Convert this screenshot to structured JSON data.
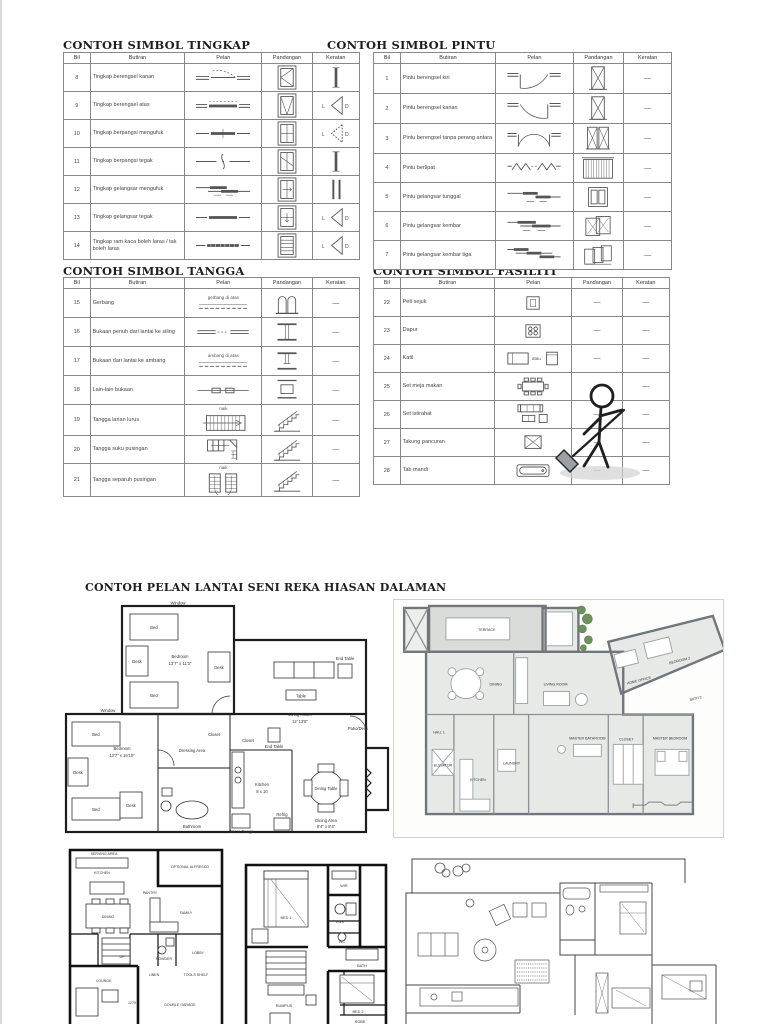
{
  "page": {
    "plans_title": "CONTOH PELAN LANTAI SENI REKA HIASAN DALAMAN"
  },
  "symbols": {
    "letter_left": "L",
    "letter_right": "D",
    "dash": "—"
  },
  "tables": {
    "tingkap": {
      "title": "CONTOH SIMBOL TINGKAP",
      "headers": [
        "Bil",
        "Butiran",
        "Pelan",
        "Pandangan",
        "Keratan"
      ],
      "rows": [
        {
          "bil": "8",
          "butiran": "Tingkap berengsel kanan",
          "pelan": {
            "icon": "window-casement-plan"
          },
          "pandangan": {
            "icon": "window-elev-casement"
          },
          "keratan": {
            "icon": "section-bar"
          }
        },
        {
          "bil": "9",
          "butiran": "Tingkap berengsel atas",
          "pelan": {
            "icon": "window-sash-plan"
          },
          "pandangan": {
            "icon": "window-elev-tophung"
          },
          "keratan": {
            "icon": "section-swing"
          }
        },
        {
          "bil": "10",
          "butiran": "Tingkap berpangsi mengufuk",
          "pelan": {
            "icon": "window-pivot-h-plan"
          },
          "pandangan": {
            "icon": "window-elev-pivot-h"
          },
          "keratan": {
            "icon": "section-pivot"
          }
        },
        {
          "bil": "11",
          "butiran": "Tingkap berpangsi tegak",
          "pelan": {
            "icon": "window-pivot-v-plan"
          },
          "pandangan": {
            "icon": "window-elev-pivot-v"
          },
          "keratan": {
            "icon": "section-bar"
          }
        },
        {
          "bil": "12",
          "butiran": "Tingkap gelangsar mengufuk",
          "pelan": {
            "icon": "window-slide-h-plan"
          },
          "pandangan": {
            "icon": "window-elev-slide-h"
          },
          "keratan": {
            "icon": "section-bar2"
          }
        },
        {
          "bil": "13",
          "butiran": "Tingkap gelangsar tegak",
          "pelan": {
            "icon": "window-slide-v-plan"
          },
          "pandangan": {
            "icon": "window-elev-slide-v"
          },
          "keratan": {
            "icon": "section-swing"
          }
        },
        {
          "bil": "14",
          "butiran": "Tingkap ram kaca boleh laras / tak boleh laras",
          "pelan": {
            "icon": "window-louvre-plan"
          },
          "pandangan": {
            "icon": "window-elev-louvre"
          },
          "keratan": {
            "icon": "section-swing"
          }
        }
      ]
    },
    "pintu": {
      "title": "CONTOH SIMBOL PINTU",
      "headers": [
        "Bil",
        "Butiran",
        "Pelan",
        "Pandangan",
        "Keratan"
      ],
      "rows": [
        {
          "bil": "1",
          "butiran": "Pintu berengsel kiri",
          "pelan": {
            "icon": "door-swing-left-plan"
          },
          "pandangan": {
            "icon": "door-elev-x"
          },
          "keratan": {
            "text": "—"
          }
        },
        {
          "bil": "2",
          "butiran": "Pintu berengsel kanan",
          "pelan": {
            "icon": "door-swing-right-plan"
          },
          "pandangan": {
            "icon": "door-elev-x"
          },
          "keratan": {
            "text": "—"
          }
        },
        {
          "bil": "3",
          "butiran": "Pintu berengsel tanpa perang antara",
          "pelan": {
            "icon": "door-double-swing-plan"
          },
          "pandangan": {
            "icon": "door-elev-double"
          },
          "keratan": {
            "text": "—"
          }
        },
        {
          "bil": "4",
          "butiran": "Pintu berlipat",
          "pelan": {
            "icon": "door-fold-plan"
          },
          "pandangan": {
            "icon": "door-elev-accordion"
          },
          "keratan": {
            "text": "—"
          }
        },
        {
          "bil": "5",
          "butiran": "Pintu gelangsar tunggal",
          "pelan": {
            "icon": "door-slide-single-plan"
          },
          "pandangan": {
            "icon": "door-elev-slide1"
          },
          "keratan": {
            "text": "—"
          }
        },
        {
          "bil": "6",
          "butiran": "Pintu gelangsar kembar",
          "pelan": {
            "icon": "door-slide-double-plan"
          },
          "pandangan": {
            "icon": "door-elev-slide2"
          },
          "keratan": {
            "text": "—"
          }
        },
        {
          "bil": "7",
          "butiran": "Pintu gelangsar kembar tiga",
          "pelan": {
            "icon": "door-slide-triple-plan"
          },
          "pandangan": {
            "icon": "door-elev-slide3"
          },
          "keratan": {
            "text": "—"
          }
        }
      ]
    },
    "tangga": {
      "title": "CONTOH SIMBOL TANGGA",
      "headers": [
        "Bil",
        "Butiran",
        "Pelan",
        "Pandangan",
        "Keratan"
      ],
      "rows": [
        {
          "bil": "15",
          "butiran": "Gerbang",
          "pelan": {
            "icon": "dashed-line-plan",
            "note": "gerbang di atas"
          },
          "pandangan": {
            "icon": "arch-elev"
          },
          "keratan": {
            "text": "—"
          }
        },
        {
          "bil": "16",
          "butiran": "Bukaan penuh dari lantai ke siling",
          "pelan": {
            "icon": "opening-plan"
          },
          "pandangan": {
            "icon": "opening-full-elev"
          },
          "keratan": {
            "text": "—"
          }
        },
        {
          "bil": "17",
          "butiran": "Bukaan dari lantai ke ambang",
          "pelan": {
            "icon": "dashed-line-plan",
            "note": "ambang di atas"
          },
          "pandangan": {
            "icon": "opening-sill-elev"
          },
          "keratan": {
            "text": "—"
          }
        },
        {
          "bil": "18",
          "butiran": "Lain-lain bukaan",
          "pelan": {
            "icon": "opening-other-plan"
          },
          "pandangan": {
            "icon": "opening-other-elev"
          },
          "keratan": {
            "text": "—"
          }
        },
        {
          "bil": "19",
          "butiran": "Tangga larian lurus",
          "pelan": {
            "icon": "stairs-straight-plan",
            "note": "naik"
          },
          "pandangan": {
            "icon": "stairs-elev"
          },
          "keratan": {
            "text": "—"
          }
        },
        {
          "bil": "20",
          "butiran": "Tangga suku pusingan",
          "pelan": {
            "icon": "stairs-quarter-plan"
          },
          "pandangan": {
            "icon": "stairs-elev"
          },
          "keratan": {
            "text": "—"
          }
        },
        {
          "bil": "21",
          "butiran": "Tangga separuh pusingan",
          "pelan": {
            "icon": "stairs-half-plan",
            "note": "naik"
          },
          "pandangan": {
            "icon": "stairs-elev"
          },
          "keratan": {
            "text": "—"
          }
        }
      ]
    },
    "fasiliti": {
      "title": "CONTOH SIMBOL FASILITI",
      "headers": [
        "Bil",
        "Butiran",
        "Pelan",
        "Pandangan",
        "Keratan"
      ],
      "rows": [
        {
          "bil": "22",
          "butiran": "Peti sejuk",
          "pelan": {
            "icon": "fridge-plan"
          },
          "pandangan": {
            "text": "—"
          },
          "keratan": {
            "text": "—"
          }
        },
        {
          "bil": "23",
          "butiran": "Dapur",
          "pelan": {
            "icon": "stove-plan"
          },
          "pandangan": {
            "text": "—"
          },
          "keratan": {
            "text": "—"
          }
        },
        {
          "bil": "24",
          "butiran": "Katil",
          "pelan": {
            "icon": "bed-plan",
            "note": "atau",
            "icon2": "bed2-plan"
          },
          "pandangan": {
            "text": "—"
          },
          "keratan": {
            "text": "—"
          }
        },
        {
          "bil": "25",
          "butiran": "Set meja makan",
          "pelan": {
            "icon": "dining-set-plan"
          },
          "pandangan": {
            "text": "—"
          },
          "keratan": {
            "text": "—"
          }
        },
        {
          "bil": "26",
          "butiran": "Set istirahat",
          "pelan": {
            "icon": "sofa-set-plan"
          },
          "pandangan": {
            "text": "—"
          },
          "keratan": {
            "text": "—"
          }
        },
        {
          "bil": "27",
          "butiran": "Takung pancuran",
          "pelan": {
            "icon": "shower-tray-plan"
          },
          "pandangan": {
            "text": "—"
          },
          "keratan": {
            "text": "—"
          }
        },
        {
          "bil": "28",
          "butiran": "Tab mandi",
          "pelan": {
            "icon": "bathtub-plan"
          },
          "pandangan": {
            "text": "—"
          },
          "keratan": {
            "text": "—"
          }
        }
      ]
    }
  },
  "plans": {
    "a": {
      "window_top": "Window",
      "window_left": "Window",
      "bed": "Bed",
      "desk": "Desk",
      "bedroom1_name": "Bedroom",
      "bedroom1_size": "13'7\" x 11'3\"",
      "bedroom2_name": "Bedroom",
      "bedroom2_size": "13'7\" x 16'10\"",
      "dressing": "Dressing Area",
      "bathroom": "Bathroom",
      "closet": "Closet",
      "table": "Table",
      "end_table": "End Table",
      "living_name": "Living Room",
      "living_size": "12' 13'8\"",
      "patio": "Patio/Deck",
      "kitchen_name": "Kitchen",
      "kitchen_size": "8 x 10",
      "dining_table": "Dining Table",
      "dining_area": "Dining Area",
      "dining_size": "8'4\" x 8'4\"",
      "micro": "Micro Range",
      "refrig": "Refrig"
    },
    "b": {
      "terrace": "TERRACE",
      "dining": "DINING",
      "living": "LIVING ROOM",
      "office": "HOME OFFICE",
      "bedroom2": "BEDROOM 2",
      "bath2": "BATH 2",
      "hall": "HALL 1",
      "elevator": "ELEVATOR",
      "kitchen": "KITCHEN",
      "laundry": "LAUNDRY",
      "master_bath": "MASTER BATHROOM",
      "closet": "CLOSET",
      "master_bed": "MASTER BEDROOM"
    },
    "c": {
      "serving": "SERVING AREA",
      "alfresco": "OPTIONAL ALFRESCO",
      "kitchen": "KITCHEN",
      "pantry": "PANTRY",
      "dining": "DINING",
      "family": "FAMILY",
      "powder": "POWDER",
      "lobby": "LOBBY",
      "up": "UP",
      "lounge": "LOUNGE",
      "linen": "LINEN",
      "tools": "TOOLS SHELF",
      "garage": "DOUBLE GARAGE",
      "dim": "1270"
    },
    "d": {
      "bed1": "BED 1",
      "wir": "WIR",
      "ens": "ENS",
      "wc": "WC",
      "bath": "BATH",
      "rumpus": "RUMPUS",
      "bed2": "BED 2",
      "robe": "ROBE"
    }
  }
}
